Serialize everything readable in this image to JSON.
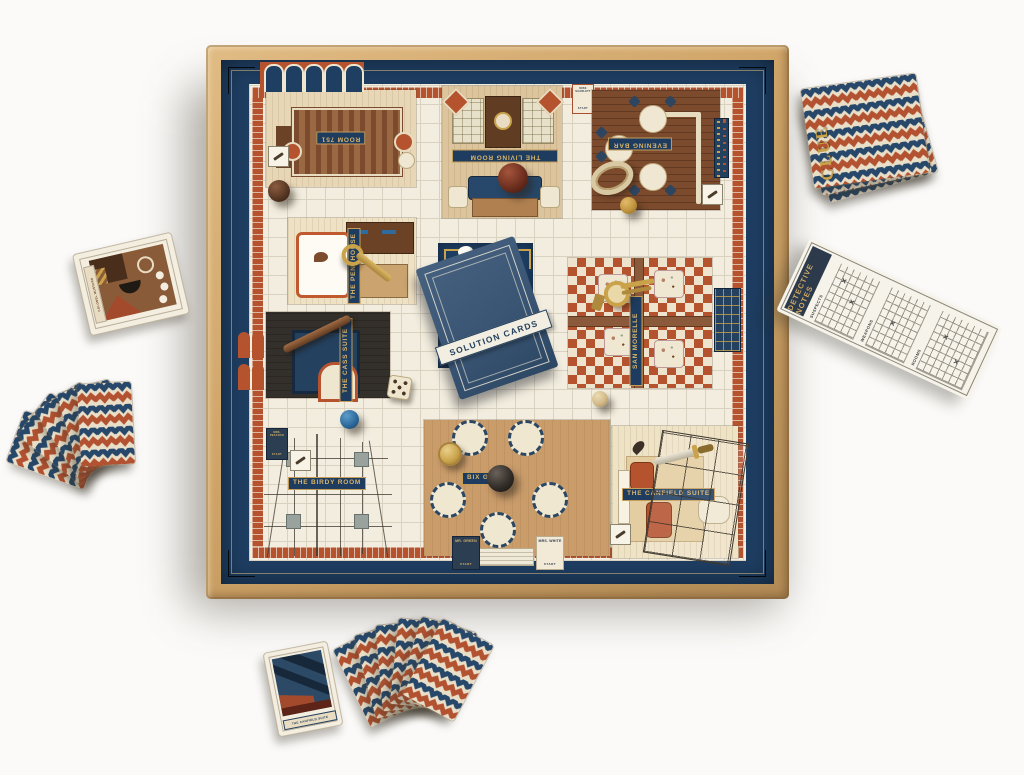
{
  "board": {
    "rooms": {
      "room751": "ROOM 751",
      "living_room": "THE LIVING ROOM",
      "evening_bar": "EVENING BAR",
      "penthouse": "THE PENTHOUSE",
      "cass_suite": "THE CASS SUITE",
      "san_morelle": "SAN MORELLE",
      "birdy_room": "THE BIRDY ROOM",
      "bix_grill": "BIX GRILL",
      "canfield_suite": "THE CANFIELD SUITE"
    },
    "center_envelope": "SOLUTION CARDS",
    "start_tags": {
      "green_name": "MR. GREEN",
      "white_name": "MRS. WHITE",
      "peacock_name": "MRS. PEACOCK",
      "scarlett_name": "MISS SCARLETT",
      "start": "START"
    }
  },
  "detective_pad": {
    "title": "DETECTIVE NOTES",
    "sections": [
      "SUSPECTS",
      "WEAPONS",
      "ROOMS"
    ],
    "mark": "✕"
  },
  "clue_deck": {
    "brand": "CLUE"
  },
  "cards": {
    "suspect_name": "COLONEL MUSTARD",
    "room_card_name": "THE CANFIELD SUITE"
  },
  "colors": {
    "navy": "#1e3e62",
    "rust": "#b5532f",
    "cream": "#f2edde",
    "gold": "#c9a24a",
    "wood": "#cfa468"
  }
}
